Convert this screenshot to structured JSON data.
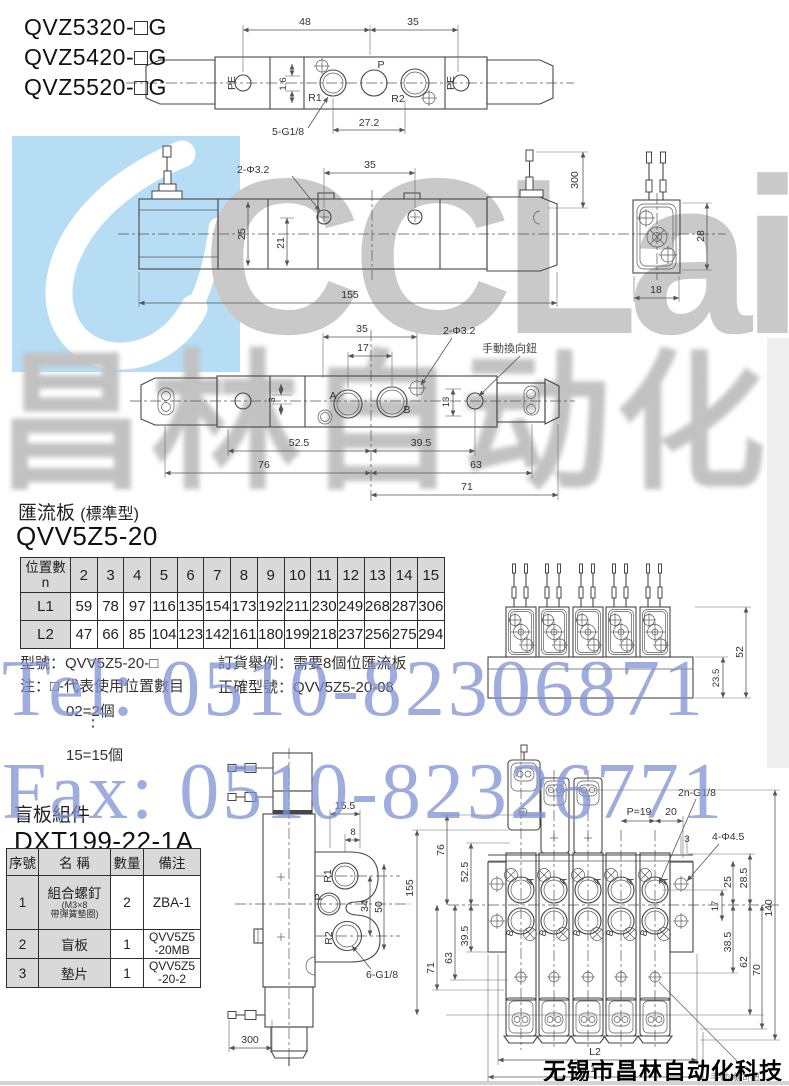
{
  "models": {
    "m1": "QVZ5320-□G",
    "m2": "QVZ5420-□G",
    "m3": "QVZ5520-□G"
  },
  "watermarks": {
    "logo": "CCLair",
    "cn": "昌林自动化",
    "tel": "Tel: 0510-82306871",
    "fax": "Fax: 0510-82326771",
    "company": "无锡市昌林自动化科技"
  },
  "d1": {
    "dim48": "48",
    "dim35": "35",
    "pe_left": "PE",
    "p": "P",
    "r1": "R1",
    "r2": "R2",
    "pe_right": "PE",
    "dim16": "1.6",
    "g": "5-G1/8",
    "dim272": "27.2"
  },
  "d2": {
    "phi": "2-Φ3.2",
    "dim35": "35",
    "dim25": "25",
    "dim21": "21",
    "dim155": "155",
    "dim300": "300",
    "dim28": "28",
    "dim18": "18"
  },
  "d3": {
    "dim35": "35",
    "dim17": "17",
    "phi": "2-Φ3.2",
    "manual": "手動換向鈕",
    "a": "A",
    "b": "B",
    "dim3": "3",
    "dim13": "13",
    "dim525": "52.5",
    "dim395": "39.5",
    "dim76": "76",
    "dim63": "63",
    "dim71": "71"
  },
  "sec1": {
    "title": "匯流板",
    "title_paren": "(標準型)",
    "model": "QVV5Z5-20",
    "table": {
      "h1": "位置數",
      "h2": "n",
      "cols": [
        "2",
        "3",
        "4",
        "5",
        "6",
        "7",
        "8",
        "9",
        "10",
        "11",
        "12",
        "13",
        "14",
        "15"
      ],
      "rows": [
        {
          "label": "L1",
          "values": [
            "59",
            "78",
            "97",
            "116",
            "135",
            "154",
            "173",
            "192",
            "211",
            "230",
            "249",
            "268",
            "287",
            "306"
          ]
        },
        {
          "label": "L2",
          "values": [
            "47",
            "66",
            "85",
            "104",
            "123",
            "142",
            "161",
            "180",
            "199",
            "218",
            "237",
            "256",
            "275",
            "294"
          ]
        }
      ]
    },
    "notes": {
      "model_line": "型號：QVV5Z5-20-□",
      "note_line": "注：□-代表使用位置數目",
      "ex1": "02=2個",
      "dots": "⋮",
      "ex2": "15=15個",
      "order1": "訂貨舉例：需要8個位匯流板",
      "order2": "正確型號：QVV5Z5-20-08"
    },
    "asm": {
      "dim52": "52",
      "dim235": "23.5"
    }
  },
  "sec2": {
    "title": "盲板組件",
    "model": "DXT199-22-1A",
    "table": {
      "headers": [
        "序號",
        "名 稱",
        "數量",
        "備注"
      ],
      "rows": [
        {
          "no": "1",
          "name": "組合螺釘",
          "sub1": "(M3×8",
          "sub2": "帶彈簧墊圈)",
          "qty": "2",
          "note1": "ZBA-1",
          "note2": ""
        },
        {
          "no": "2",
          "name": "盲板",
          "sub1": "",
          "sub2": "",
          "qty": "1",
          "note1": "QVV5Z5",
          "note2": "-20MB"
        },
        {
          "no": "3",
          "name": "墊片",
          "sub1": "",
          "sub2": "",
          "qty": "1",
          "note1": "QVV5Z5",
          "note2": "-20-2"
        }
      ]
    }
  },
  "d5": {
    "dim155": "15.5",
    "dim8": "8",
    "r1": "R1",
    "p": "P",
    "r2": "R2",
    "dim34": "34",
    "dim50": "50",
    "g": "6-G1/8",
    "dim300": "300"
  },
  "d6": {
    "g": "2n-G1/8",
    "p19": "P=19",
    "dim20": "20",
    "dim3": "3",
    "phi": "4-Φ4.5",
    "dim155": "155",
    "dim76": "76",
    "dim525": "52.5",
    "dim395": "39.5",
    "dim71": "71",
    "dim63": "63",
    "dim25": "25",
    "dim285": "28.5",
    "dim17": "17",
    "dim140": "140",
    "dim385": "38.5",
    "dim62": "62",
    "dim70": "70",
    "l1": "L1",
    "l2": "L2",
    "a": "A",
    "b": "B",
    "manual": "手動換向鈕"
  }
}
